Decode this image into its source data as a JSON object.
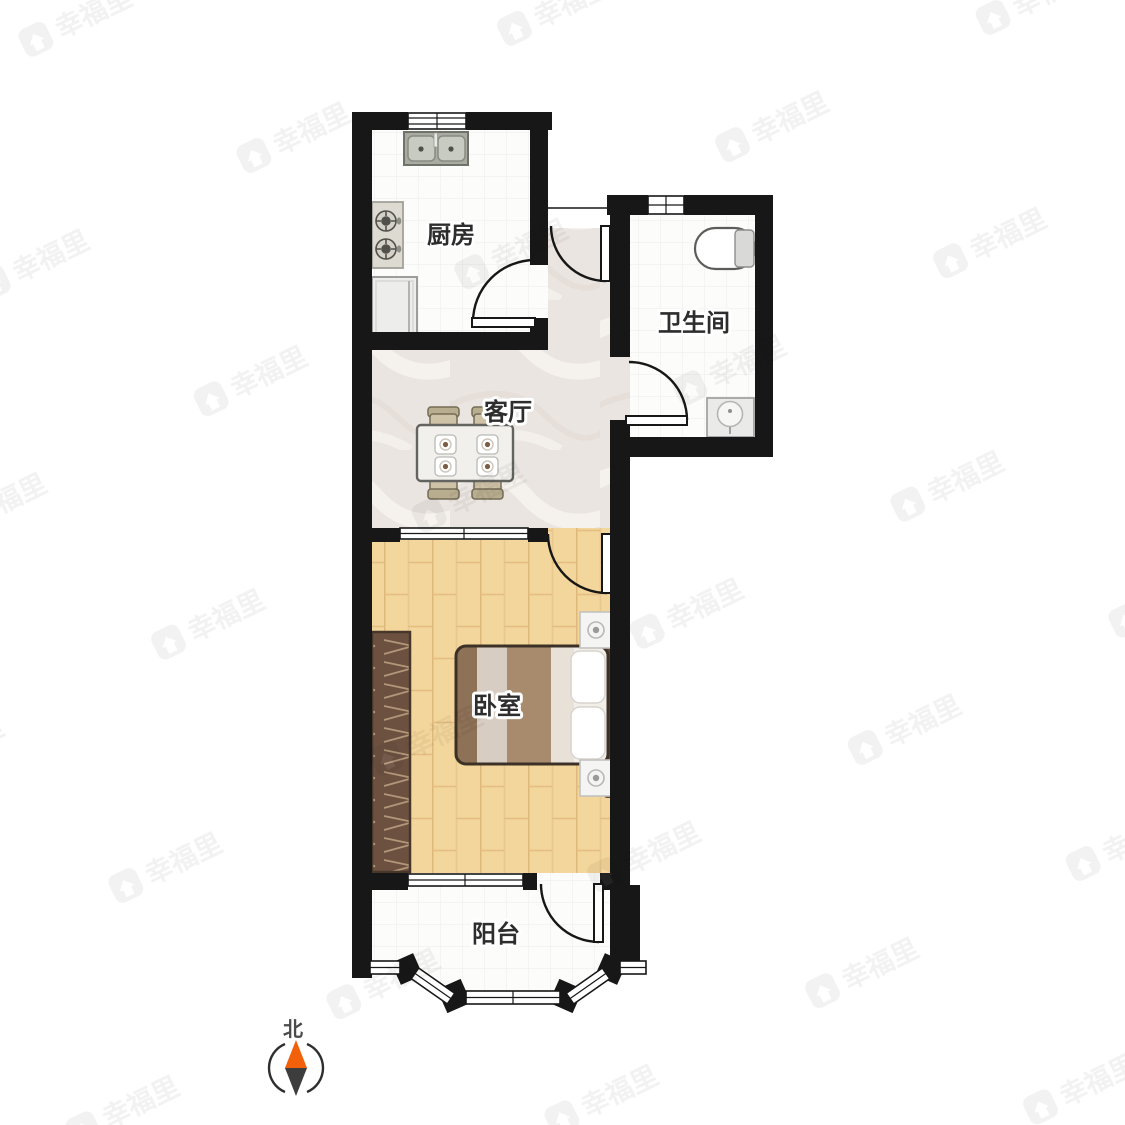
{
  "plan": {
    "type": "apartment-floorplan",
    "rooms": [
      {
        "name": "kitchen",
        "label": "厨房",
        "fixtures": [
          "sink",
          "stove",
          "fridge"
        ]
      },
      {
        "name": "bathroom",
        "label": "卫生间",
        "fixtures": [
          "toilet",
          "washbasin"
        ]
      },
      {
        "name": "living-room",
        "label": "客厅",
        "fixtures": [
          "dining-table",
          "chairs"
        ]
      },
      {
        "name": "bedroom",
        "label": "卧室",
        "fixtures": [
          "double-bed",
          "nightstand",
          "nightstand",
          "wardrobe"
        ]
      },
      {
        "name": "balcony",
        "label": "阳台",
        "fixtures": []
      }
    ],
    "doors": [
      "entrance-door",
      "kitchen-door",
      "bathroom-door",
      "bedroom-door",
      "balcony-door"
    ],
    "compass": {
      "label": "北",
      "needle_up_color": "#f2600a",
      "needle_down_color": "#3d3d3d"
    },
    "watermark": {
      "brand": "幸福里",
      "icon": "home-icon"
    },
    "colors": {
      "wall": "#171717",
      "wood_floor": "#f3d69b",
      "marble_floor": "#ebe5e1",
      "tile_floor": "#fcfcfb",
      "wardrobe": "#6d5140",
      "bed_stripe_dark": "#a78b6c",
      "bed_stripe_light": "#d8cdc2"
    }
  }
}
